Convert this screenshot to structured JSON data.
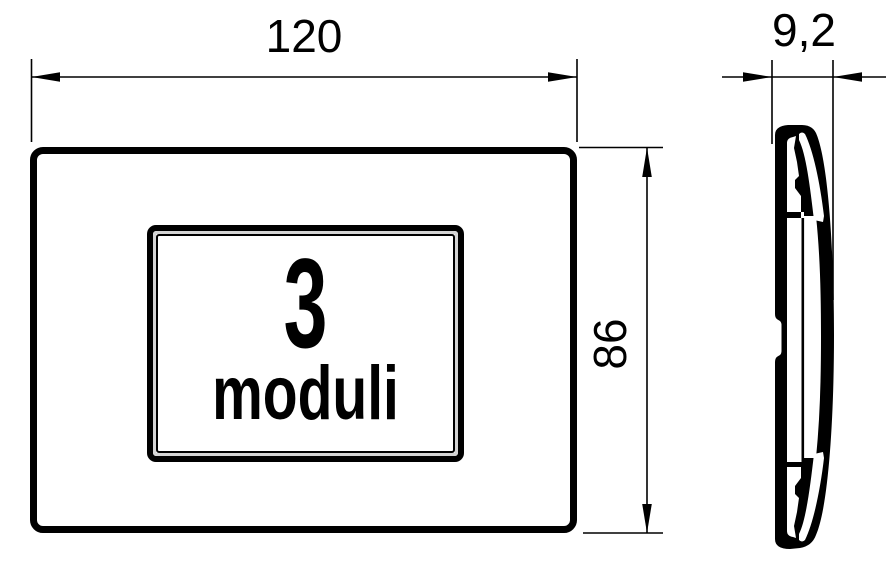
{
  "front_view": {
    "module_count": "3",
    "module_unit": "moduli"
  },
  "dimensions": {
    "width": "120",
    "height": "86",
    "depth": "9,2"
  },
  "colors": {
    "ink": "#000000",
    "paper": "#ffffff",
    "frame_gap": "#d4d4d4"
  }
}
